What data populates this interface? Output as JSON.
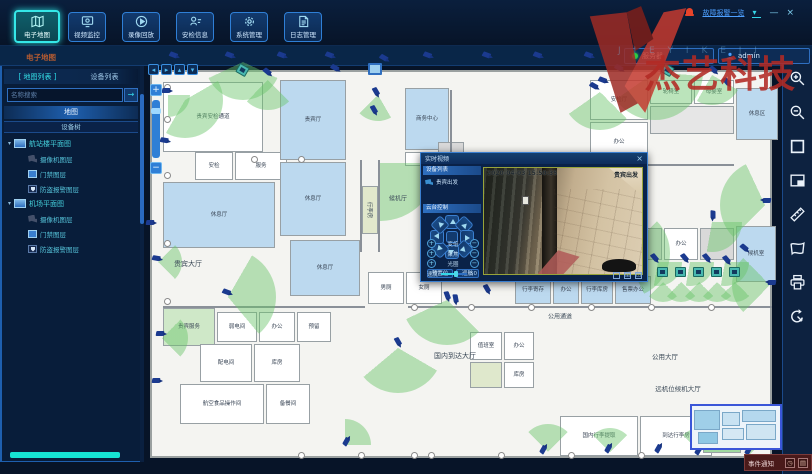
{
  "window": {
    "alarm_link": "故障报警一览",
    "watermark_text": "杰艺科技",
    "watermark_latin": "J I E Y I K E J I",
    "server_status": "服务器",
    "username": "admin",
    "minimize": "—",
    "close": "×"
  },
  "nav": {
    "items": [
      {
        "label": "电子地图",
        "active": true
      },
      {
        "label": "视频监控",
        "active": false
      },
      {
        "label": "录像回放",
        "active": false
      },
      {
        "label": "安检信息",
        "active": false
      },
      {
        "label": "系统管理",
        "active": false
      },
      {
        "label": "日志管理",
        "active": false
      }
    ]
  },
  "breadcrumb": "电子地图",
  "sidebar": {
    "tab_map": "地图列表",
    "tab_device": "设备列表",
    "search_placeholder": "名称搜索",
    "search_button": "→",
    "section_map": "地图",
    "section_tree": "设备树",
    "tree": [
      {
        "label": "航站楼平面图",
        "children": [
          {
            "type": "camera",
            "label": "摄像机图层"
          },
          {
            "type": "door",
            "label": "门禁图层"
          },
          {
            "type": "shield",
            "label": "防盗报警图层"
          }
        ]
      },
      {
        "label": "机场平面图",
        "children": [
          {
            "type": "camera",
            "label": "摄像机图层"
          },
          {
            "type": "door",
            "label": "门禁图层"
          },
          {
            "type": "shield",
            "label": "防盗报警图层"
          }
        ]
      }
    ]
  },
  "map": {
    "rooms": [
      [
        163,
        82,
        100,
        70,
        "#ffffff",
        "贵宾安检通道"
      ],
      [
        195,
        152,
        38,
        28,
        "#ffffff",
        "安检"
      ],
      [
        235,
        152,
        52,
        28,
        "#ffffff",
        "服务"
      ],
      [
        163,
        182,
        112,
        66,
        "#bcd9ef",
        "休息厅"
      ],
      [
        280,
        80,
        66,
        80,
        "#bcd9ef",
        "贵宾厅"
      ],
      [
        280,
        162,
        66,
        74,
        "#bcd9ef",
        "休息厅"
      ],
      [
        290,
        240,
        70,
        56,
        "#bcd9ef",
        "休息厅"
      ],
      [
        362,
        186,
        16,
        48,
        "#e2e8cc",
        ""
      ],
      [
        405,
        88,
        44,
        62,
        "#bcd9ef",
        "商务中心"
      ],
      [
        405,
        152,
        44,
        14,
        "#ffffff",
        "更衣"
      ],
      [
        438,
        142,
        26,
        24,
        "#d9d9d9",
        ""
      ],
      [
        590,
        80,
        58,
        40,
        "#ffffff",
        "安检厅"
      ],
      [
        650,
        80,
        42,
        24,
        "#ffffff",
        "轮椅室"
      ],
      [
        694,
        80,
        40,
        24,
        "#ffffff",
        "母婴室"
      ],
      [
        650,
        106,
        84,
        28,
        "#e6e6e6",
        ""
      ],
      [
        736,
        88,
        42,
        52,
        "#bcd9ef",
        "休息区"
      ],
      [
        590,
        122,
        58,
        40,
        "#ffffff",
        "办公"
      ],
      [
        560,
        228,
        34,
        32,
        "#d9d9d9",
        ""
      ],
      [
        596,
        228,
        32,
        32,
        "#ffffff",
        "库房"
      ],
      [
        630,
        228,
        32,
        32,
        "#d9d9d9",
        ""
      ],
      [
        664,
        228,
        34,
        32,
        "#ffffff",
        "办公"
      ],
      [
        700,
        228,
        34,
        32,
        "#d9d9d9",
        ""
      ],
      [
        736,
        226,
        40,
        56,
        "#bcd9ef",
        "候机室"
      ],
      [
        515,
        276,
        36,
        28,
        "#bcd9ef",
        "行李寄存"
      ],
      [
        553,
        276,
        26,
        28,
        "#bcd9ef",
        "办公"
      ],
      [
        581,
        276,
        32,
        28,
        "#bcd9ef",
        "行李库房"
      ],
      [
        615,
        276,
        36,
        28,
        "#bcd9ef",
        "售票办公"
      ],
      [
        368,
        272,
        36,
        32,
        "#ffffff",
        "男厕"
      ],
      [
        406,
        272,
        36,
        32,
        "#ffffff",
        "女厕"
      ],
      [
        163,
        308,
        52,
        38,
        "#cfe8c8",
        "贵宾服务"
      ],
      [
        217,
        312,
        40,
        30,
        "#ffffff",
        "弱电间"
      ],
      [
        259,
        312,
        36,
        30,
        "#ffffff",
        "办公"
      ],
      [
        297,
        312,
        34,
        30,
        "#ffffff",
        "预留"
      ],
      [
        200,
        344,
        52,
        38,
        "#ffffff",
        "配电间"
      ],
      [
        254,
        344,
        46,
        38,
        "#ffffff",
        "库房"
      ],
      [
        180,
        384,
        84,
        40,
        "#ffffff",
        "航空食品操作间"
      ],
      [
        266,
        384,
        44,
        40,
        "#ffffff",
        "备餐间"
      ],
      [
        470,
        332,
        32,
        28,
        "#ffffff",
        "值班室"
      ],
      [
        504,
        332,
        30,
        28,
        "#ffffff",
        "办公"
      ],
      [
        470,
        362,
        32,
        26,
        "#dfe8cc",
        ""
      ],
      [
        504,
        362,
        30,
        26,
        "#ffffff",
        "库房"
      ],
      [
        560,
        416,
        78,
        40,
        "#ffffff",
        "国内行李提取"
      ],
      [
        640,
        416,
        72,
        40,
        "#ffffff",
        "到达行李房"
      ],
      [
        703,
        444,
        38,
        9,
        "#9fd89f",
        ""
      ]
    ],
    "walls": [
      [
        360,
        160,
        2,
        92
      ],
      [
        378,
        160,
        2,
        92
      ],
      [
        408,
        306,
        364,
        2
      ],
      [
        163,
        306,
        202,
        2
      ],
      [
        450,
        90,
        2,
        62
      ],
      [
        590,
        164,
        144,
        2
      ]
    ],
    "labels": [
      [
        188,
        264,
        "贵宾大厅",
        7,
        ""
      ],
      [
        398,
        198,
        "候机厅",
        6,
        ""
      ],
      [
        370,
        210,
        "行李房",
        5.5,
        "v"
      ],
      [
        560,
        316,
        "公用通道",
        6,
        ""
      ],
      [
        455,
        356,
        "国内到达大厅",
        7,
        ""
      ],
      [
        665,
        356,
        "公用大厅",
        6.5,
        ""
      ],
      [
        678,
        388,
        "远机位候机大厅",
        6.5,
        ""
      ]
    ],
    "fans": [
      [
        243,
        62,
        38,
        115,
        130
      ],
      [
        185,
        100,
        38,
        60,
        150
      ],
      [
        168,
        95,
        22,
        90,
        90
      ],
      [
        268,
        80,
        30,
        135,
        90
      ],
      [
        378,
        95,
        26,
        150,
        75
      ],
      [
        380,
        163,
        58,
        90,
        90
      ],
      [
        600,
        92,
        38,
        135,
        100
      ],
      [
        655,
        72,
        48,
        95,
        140
      ],
      [
        712,
        75,
        30,
        120,
        90
      ],
      [
        625,
        253,
        45,
        45,
        110
      ],
      [
        447,
        300,
        45,
        135,
        110
      ],
      [
        228,
        297,
        48,
        30,
        110
      ],
      [
        398,
        348,
        45,
        120,
        110
      ],
      [
        162,
        338,
        26,
        45,
        90
      ],
      [
        158,
        262,
        24,
        45,
        90
      ],
      [
        765,
        205,
        45,
        225,
        110
      ],
      [
        770,
        285,
        38,
        225,
        90
      ],
      [
        712,
        222,
        30,
        90,
        100
      ],
      [
        663,
        282,
        20,
        135,
        90
      ],
      [
        681,
        282,
        20,
        135,
        90
      ],
      [
        699,
        282,
        20,
        135,
        90
      ],
      [
        717,
        282,
        20,
        135,
        90
      ],
      [
        735,
        282,
        20,
        135,
        90
      ],
      [
        658,
        262,
        24,
        90,
        100
      ],
      [
        690,
        262,
        24,
        90,
        100
      ],
      [
        725,
        262,
        24,
        90,
        100
      ],
      [
        548,
        452,
        28,
        315,
        90
      ],
      [
        610,
        452,
        24,
        315,
        90
      ],
      [
        345,
        445,
        26,
        0,
        90
      ],
      [
        700,
        452,
        24,
        315,
        90
      ],
      [
        750,
        454,
        20,
        315,
        90
      ]
    ],
    "cameras": [
      [
        175,
        57,
        20,
        ""
      ],
      [
        231,
        57,
        20,
        ""
      ],
      [
        283,
        57,
        20,
        ""
      ],
      [
        331,
        57,
        20,
        ""
      ],
      [
        385,
        60,
        30,
        ""
      ],
      [
        429,
        57,
        20,
        ""
      ],
      [
        488,
        57,
        20,
        ""
      ],
      [
        539,
        57,
        20,
        ""
      ],
      [
        590,
        57,
        20,
        ""
      ],
      [
        643,
        57,
        20,
        ""
      ],
      [
        652,
        60,
        40,
        ""
      ],
      [
        704,
        57,
        20,
        ""
      ],
      [
        733,
        57,
        20,
        ""
      ],
      [
        762,
        57,
        20,
        ""
      ],
      [
        374,
        68,
        0,
        "panel"
      ],
      [
        168,
        92,
        0,
        ""
      ],
      [
        166,
        142,
        10,
        ""
      ],
      [
        243,
        70,
        30,
        "box"
      ],
      [
        268,
        74,
        40,
        ""
      ],
      [
        336,
        70,
        30,
        ""
      ],
      [
        376,
        94,
        60,
        ""
      ],
      [
        374,
        112,
        60,
        ""
      ],
      [
        595,
        88,
        30,
        ""
      ],
      [
        604,
        82,
        20,
        ""
      ],
      [
        620,
        70,
        30,
        ""
      ],
      [
        668,
        70,
        30,
        "box"
      ],
      [
        714,
        72,
        40,
        ""
      ],
      [
        727,
        84,
        50,
        ""
      ],
      [
        152,
        224,
        0,
        ""
      ],
      [
        158,
        260,
        10,
        ""
      ],
      [
        162,
        335,
        0,
        ""
      ],
      [
        158,
        382,
        0,
        ""
      ],
      [
        228,
        294,
        20,
        ""
      ],
      [
        398,
        344,
        60,
        ""
      ],
      [
        447,
        298,
        70,
        ""
      ],
      [
        455,
        301,
        80,
        ""
      ],
      [
        487,
        291,
        60,
        ""
      ],
      [
        625,
        250,
        40,
        ""
      ],
      [
        655,
        260,
        50,
        ""
      ],
      [
        685,
        260,
        50,
        ""
      ],
      [
        707,
        260,
        50,
        ""
      ],
      [
        727,
        262,
        50,
        ""
      ],
      [
        745,
        250,
        40,
        ""
      ],
      [
        765,
        200,
        180,
        ""
      ],
      [
        770,
        282,
        180,
        ""
      ],
      [
        712,
        217,
        90,
        ""
      ],
      [
        545,
        449,
        300,
        ""
      ],
      [
        610,
        448,
        300,
        ""
      ],
      [
        660,
        448,
        300,
        ""
      ],
      [
        700,
        450,
        300,
        ""
      ],
      [
        348,
        441,
        300,
        ""
      ],
      [
        750,
        450,
        300,
        ""
      ],
      [
        663,
        272,
        0,
        "box"
      ],
      [
        681,
        272,
        0,
        "box"
      ],
      [
        699,
        272,
        0,
        "box"
      ],
      [
        717,
        272,
        0,
        "box"
      ],
      [
        735,
        272,
        0,
        "box"
      ]
    ],
    "columns": [
      [
        168,
        88
      ],
      [
        168,
        120
      ],
      [
        168,
        176
      ],
      [
        168,
        244
      ],
      [
        168,
        302
      ],
      [
        302,
        160
      ],
      [
        415,
        308
      ],
      [
        472,
        308
      ],
      [
        532,
        308
      ],
      [
        592,
        308
      ],
      [
        652,
        308
      ],
      [
        712,
        308
      ],
      [
        302,
        456
      ],
      [
        362,
        456
      ],
      [
        432,
        456
      ],
      [
        502,
        456
      ],
      [
        572,
        456
      ],
      [
        642,
        456
      ],
      [
        255,
        160
      ],
      [
        415,
        456
      ]
    ]
  },
  "video_popup": {
    "title": "实时视频",
    "close": "×",
    "device_section": "设备列表",
    "device_name": "贵宾出发",
    "ptz_section": "云台控制",
    "controls": [
      {
        "plus": "+",
        "label": "变倍",
        "minus": "−"
      },
      {
        "plus": "+",
        "label": "聚焦",
        "minus": "−"
      },
      {
        "plus": "+",
        "label": "光圈",
        "minus": "−"
      }
    ],
    "preset_button": "预置位",
    "cruise_button": "巡航",
    "wiper_button": "雨刷",
    "speed_label": "速度",
    "speed_value": "50",
    "osd_time": "2020-04-03 15:50:35",
    "osd_name": "贵宾出发"
  },
  "event_bar": {
    "label": "事件通知"
  },
  "colors": {
    "accent": "#35e0e0",
    "alarm_red": "#e8442a",
    "panel_border": "#2f6fc0",
    "fan_green": "rgba(104,196,104,0.45)",
    "watermark_red": "#b22a24"
  }
}
